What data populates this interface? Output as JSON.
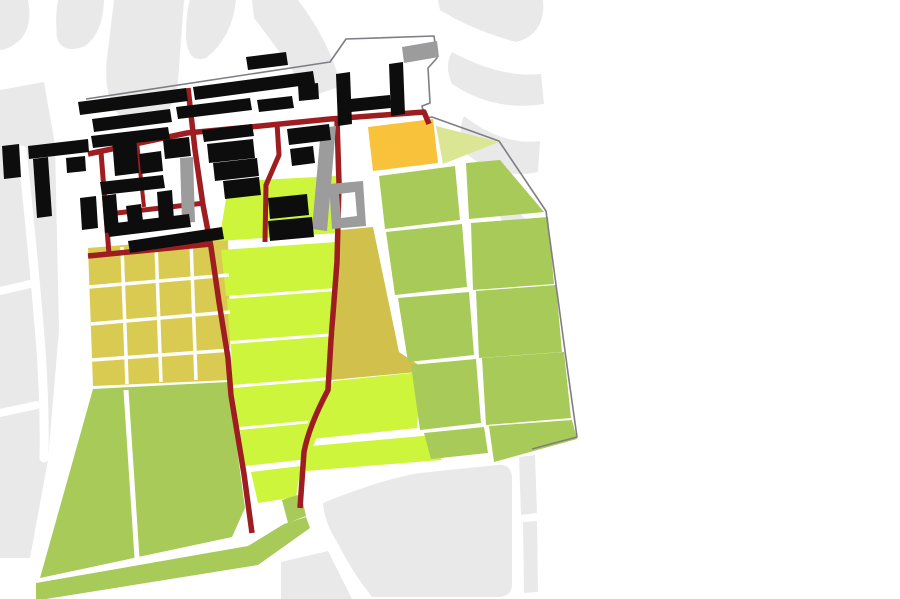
{
  "title": "urban-landuse-site-plan",
  "palette": {
    "background": "#ffffff",
    "city_block": "#e9e9e9",
    "street": "#ffffff",
    "site_boundary": "#7e7e84",
    "road": "#9e1d20",
    "building_primary": "#0d0d0d",
    "building_secondary": "#9c9c9c",
    "parcel_chartreuse": "#ccf53c",
    "parcel_green": "#a7ca58",
    "parcel_khaki": "#d9cb52",
    "parcel_olive": "#d1c14c",
    "parcel_orange": "#f8c23a",
    "parcel_pale_green": "#dbe695"
  },
  "map": {
    "viewbox": "0 0 900 599",
    "layers": [
      {
        "name": "city-blocks",
        "fill": "#e9e9e9",
        "shapes": [
          {
            "name": "block-topleft-1",
            "d": "M 0,0 L 28,0 Q 33,26 20,40 Q 8,50 0,50 Z"
          },
          {
            "name": "block-topleft-2",
            "d": "M 58,0 L 104,0 Q 103,33 85,46 Q 63,55 57,38 Q 55,15 58,0 Z"
          },
          {
            "name": "block-topleft-band",
            "d": "M 114,0 L 184,0 L 177,94 Q 158,138 121,117 Q 101,98 108,50 Z"
          },
          {
            "name": "block-left-strip",
            "d": "M 0,90 L 44,82 L 55,145 L 59,330 L 48,460 L 30,558 L 0,558 Z"
          },
          {
            "name": "block-topcenter-swoosh-left",
            "d": "M 190,0 L 236,0 Q 232,38 206,58 Q 188,64 186,38 Q 186,12 190,0 Z"
          },
          {
            "name": "block-topcenter-swoosh-right",
            "d": "M 252,0 L 298,0 Q 330,42 341,86 L 310,97 Q 283,55 254,18 Z"
          },
          {
            "name": "block-topright-swoosh-1",
            "d": "M 438,0 L 543,0 Q 546,34 516,42 Q 472,30 440,10 Z"
          },
          {
            "name": "block-topright-swoosh-2",
            "d": "M 452,52 Q 500,78 541,74 L 544,104 Q 494,112 452,84 Q 444,66 452,52 Z"
          },
          {
            "name": "block-topright-swoosh-3",
            "d": "M 464,116 Q 503,146 540,141 L 538,172 Q 499,180 468,155 Q 456,134 464,116 Z"
          },
          {
            "name": "block-topright-swoosh-4",
            "d": "M 495,185 Q 515,205 531,227 L 512,237 Q 498,213 487,197 Z"
          },
          {
            "name": "block-bottomright-main",
            "d": "M 323,503 Q 382,479 420,473 L 497,465 Q 511,463 512,477 L 512,584 Q 512,597 498,597 L 372,597 Q 352,572 337,542 Q 324,521 323,503 Z"
          },
          {
            "name": "block-bottomcenter",
            "d": "M 281,562 L 328,551 L 352,599 L 281,599 Z"
          },
          {
            "name": "block-bottomright-strip-1",
            "d": "M 519,457 L 535,455 L 537,513 L 521,515 Z"
          },
          {
            "name": "block-bottomright-strip-2",
            "d": "M 523,522 L 537,521 L 538,592 L 524,593 Z"
          }
        ]
      },
      {
        "name": "city-streets",
        "stroke": "#ffffff",
        "cap": "round",
        "shapes": [
          {
            "name": "street-left-curved",
            "d": "M 22,150 Q 34,260 41,350 Q 45,410 44,458",
            "w": 9
          },
          {
            "name": "street-left-cut-1",
            "d": "M 0,291 L 30,284",
            "w": 8
          },
          {
            "name": "street-left-cut-2",
            "d": "M 0,413 L 37,405",
            "w": 8
          }
        ]
      },
      {
        "name": "parcels",
        "shapes": [
          {
            "name": "parcel-khaki-grid",
            "fill": "#d9cb52",
            "d": "M 88,248 L 228,236 L 231,380 L 93,386 Z"
          },
          {
            "name": "parcel-olive",
            "fill": "#d1c14c",
            "d": "M 340,230 L 373,227 L 399,352 L 428,371 L 331,380 L 336,300 Z"
          },
          {
            "name": "parcel-orange",
            "fill": "#f8c23a",
            "d": "M 368,127 L 433,119 L 438,163 L 373,171 Z"
          },
          {
            "name": "parcel-pale-triangle",
            "fill": "#dbe695",
            "d": "M 436,126 L 499,142 L 443,164 Z"
          },
          {
            "name": "parcel-chartreuse-1",
            "fill": "#ccf53c",
            "d": "M 228,187 Q 232,182 240,181 L 336,176 L 337,233 L 219,241 Z"
          },
          {
            "name": "parcel-chartreuse-2",
            "fill": "#ccf53c",
            "d": "M 221,250 L 336,242 L 336,288 L 226,296 Z"
          },
          {
            "name": "parcel-chartreuse-3",
            "fill": "#ccf53c",
            "d": "M 227,299 L 336,291 L 335,333 L 230,341 Z"
          },
          {
            "name": "parcel-chartreuse-4",
            "fill": "#ccf53c",
            "d": "M 231,344 L 334,336 L 331,377 L 232,385 Z"
          },
          {
            "name": "parcel-chartreuse-5",
            "fill": "#ccf53c",
            "d": "M 233,388 L 330,380 L 325,419 L 239,427 Z"
          },
          {
            "name": "parcel-chartreuse-6",
            "fill": "#ccf53c",
            "d": "M 240,430 L 323,422 L 308,459 L 245,466 Z"
          },
          {
            "name": "parcel-chartreuse-7",
            "fill": "#ccf53c",
            "d": "M 251,472 L 301,466 L 296,497 L 258,503 Z"
          },
          {
            "name": "parcel-chartreuse-8",
            "fill": "#ccf53c",
            "d": "M 333,381 L 421,372 L 417,428 L 302,440 L 311,414 L 326,394 Z"
          },
          {
            "name": "parcel-chartreuse-9",
            "fill": "#ccf53c",
            "d": "M 300,447 L 444,434 L 441,460 L 306,471 Z"
          },
          {
            "name": "parcel-green-r1-left",
            "fill": "#a7ca58",
            "d": "M 379,176 L 455,166 L 460,220 L 385,229 Z"
          },
          {
            "name": "parcel-green-r1-right",
            "fill": "#a7ca58",
            "d": "M 466,163 L 500,160 L 544,212 L 469,219 Z"
          },
          {
            "name": "parcel-green-r2-left",
            "fill": "#a7ca58",
            "d": "M 386,232 L 462,224 L 467,287 L 395,295 Z"
          },
          {
            "name": "parcel-green-r2-right",
            "fill": "#a7ca58",
            "d": "M 471,223 L 548,217 L 554,284 L 473,290 Z"
          },
          {
            "name": "parcel-green-r3-left",
            "fill": "#a7ca58",
            "d": "M 398,298 L 469,292 L 474,355 L 408,362 Z"
          },
          {
            "name": "parcel-green-r3-right",
            "fill": "#a7ca58",
            "d": "M 476,291 L 556,285 L 562,352 L 479,358 Z"
          },
          {
            "name": "parcel-green-r4-left",
            "fill": "#a7ca58",
            "d": "M 411,365 L 476,359 L 481,423 L 420,430 Z"
          },
          {
            "name": "parcel-green-r4-right",
            "fill": "#a7ca58",
            "d": "M 482,358 L 564,352 L 571,418 L 486,425 Z"
          },
          {
            "name": "parcel-green-r5-left",
            "fill": "#a7ca58",
            "d": "M 424,433 L 484,427 L 488,453 L 431,459 Z"
          },
          {
            "name": "parcel-green-r5-right",
            "fill": "#a7ca58",
            "d": "M 489,426 L 572,420 L 577,439 L 494,462 Z"
          },
          {
            "name": "parcel-green-southwest",
            "fill": "#a7ca58",
            "d": "M 93,389 L 228,382 L 245,508 L 232,537 L 40,578 Z"
          },
          {
            "name": "parcel-green-band-tip",
            "fill": "#a7ca58",
            "d": "M 282,500 L 301,494 L 306,516 L 288,523 Z"
          },
          {
            "name": "parcel-green-band",
            "fill": "#a7ca58",
            "d": "M 36,583 L 248,546 L 284,524 L 306,517 L 310,528 L 258,565 L 46,599 L 36,599 Z"
          }
        ]
      },
      {
        "name": "parcel-streets",
        "stroke": "#ffffff",
        "shapes": [
          {
            "name": "khaki-street-v1",
            "d": "M 122,247 L 127,384",
            "w": 3.5
          },
          {
            "name": "khaki-street-v2",
            "d": "M 156,244 L 161,382",
            "w": 3.5
          },
          {
            "name": "khaki-street-v3",
            "d": "M 191,241 L 196,380",
            "w": 3.5
          },
          {
            "name": "khaki-street-h1",
            "d": "M 89,287 L 229,275",
            "w": 3.5
          },
          {
            "name": "khaki-street-h2",
            "d": "M 91,324 L 230,312",
            "w": 3.5
          },
          {
            "name": "khaki-street-h3",
            "d": "M 92,360 L 231,350",
            "w": 3.5
          },
          {
            "name": "green-southwest-divider",
            "d": "M 126,390 L 137,558",
            "w": 5
          }
        ]
      },
      {
        "name": "site-boundary",
        "stroke": "#7e7e84",
        "shapes": [
          {
            "name": "boundary-line",
            "d": "M 86,99 L 330,62 L 346,39 L 434,36 L 437,58 L 428,68 L 430,103 L 422,106 L 425,118 L 432,117 L 499,141 L 546,211 L 568,373 L 577,437 L 532,449",
            "w": 1.6
          }
        ]
      },
      {
        "name": "roads",
        "stroke": "#9e1d20",
        "shapes": [
          {
            "name": "road-top-horizontal",
            "d": "M 88,154 L 187,133 L 250,127 L 330,119 L 424,112 L 429,124",
            "w": 5.5
          },
          {
            "name": "road-mid-horizontal",
            "d": "M 108,214 L 205,203",
            "w": 5
          },
          {
            "name": "road-lower-horizontal",
            "d": "M 88,256 L 211,244",
            "w": 5.5
          },
          {
            "name": "road-west-vertical",
            "d": "M 101,152 L 109,254",
            "w": 5
          },
          {
            "name": "road-short-vertical",
            "d": "M 137,142 L 144,207",
            "w": 4
          },
          {
            "name": "road-long-west-vertical",
            "d": "M 188,88 L 195,150 L 203,205 L 211,247 L 219,302 L 228,358 L 231,395 L 244,474 L 252,533",
            "w": 5.5
          },
          {
            "name": "road-center-vertical",
            "d": "M 277,123 L 279,155 L 266,185 L 265,242",
            "w": 5
          },
          {
            "name": "road-long-east-vertical",
            "d": "M 337,120 L 339,183 L 337,262 L 331,340 L 328,390 Q 309,426 304,452 L 300,508",
            "w": 5.5
          }
        ]
      },
      {
        "name": "buildings-secondary",
        "fill": "#9c9c9c",
        "shapes": [
          {
            "name": "gray-slab",
            "d": "M 321,128 L 336,126 L 327,231 L 312,229 Z"
          },
          {
            "name": "gray-bar",
            "d": "M 180,158 L 193,157 L 195,222 L 182,223 Z"
          },
          {
            "name": "gray-topright-bar",
            "d": "M 402,47 L 437,41 L 439,57 L 404,63 Z"
          },
          {
            "name": "gray-ring-building",
            "rule": "evenodd",
            "d": "M 329,184 L 363,181 L 366,226 L 332,229 Z M 339,194 L 355,192 L 357,216 L 341,218 Z"
          }
        ]
      },
      {
        "name": "buildings-primary",
        "fill": "#0d0d0d",
        "shapes": [
          {
            "name": "bldg-row1-a",
            "d": "M 78,102 L 186,88 L 188,101 L 80,115 Z"
          },
          {
            "name": "bldg-row1-b",
            "d": "M 193,87 L 313,71 L 315,84 L 195,100 Z"
          },
          {
            "name": "bldg-row2-a",
            "d": "M 92,119 L 170,109 L 172,122 L 94,132 Z"
          },
          {
            "name": "bldg-row2-b",
            "d": "M 176,107 L 250,98 L 252,110 L 178,119 Z"
          },
          {
            "name": "bldg-row2-c",
            "d": "M 257,100 L 292,96 L 294,108 L 259,112 Z"
          },
          {
            "name": "bldg-top-small",
            "d": "M 246,57 L 286,52 L 288,65 L 248,70 Z"
          },
          {
            "name": "bldg-h-left",
            "d": "M 336,74 L 350,72 L 352,124 L 338,126 Z"
          },
          {
            "name": "bldg-h-right",
            "d": "M 389,64 L 403,62 L 405,114 L 391,116 Z"
          },
          {
            "name": "bldg-h-cross",
            "d": "M 350,99 L 390,95 L 391,108 L 351,112 Z"
          },
          {
            "name": "bldg-h-small",
            "d": "M 298,85 L 318,83 L 319,99 L 299,101 Z"
          },
          {
            "name": "bldg-row3-a",
            "d": "M 91,136 L 168,127 L 170,139 L 93,148 Z"
          },
          {
            "name": "bldg-row3-b",
            "d": "M 202,130 L 252,124 L 254,136 L 204,142 Z"
          },
          {
            "name": "bldg-row3-c",
            "d": "M 287,129 L 329,124 L 331,140 L 289,145 Z"
          },
          {
            "name": "bldg-mid-a",
            "d": "M 112,139 L 136,136 L 139,173 L 115,176 Z"
          },
          {
            "name": "bldg-mid-b",
            "d": "M 139,154 L 161,151 L 163,171 L 141,174 Z"
          },
          {
            "name": "bldg-mid-c",
            "d": "M 163,140 L 189,137 L 191,156 L 165,159 Z"
          },
          {
            "name": "bldg-mid-d",
            "d": "M 207,144 L 253,139 L 255,158 L 209,163 Z"
          },
          {
            "name": "bldg-mid-e",
            "d": "M 290,149 L 313,146 L 315,163 L 292,166 Z"
          },
          {
            "name": "bldg-mid-f",
            "d": "M 213,163 L 257,158 L 259,176 L 215,181 Z"
          },
          {
            "name": "bldg-east-a",
            "d": "M 268,198 L 307,194 L 309,215 L 270,219 Z"
          },
          {
            "name": "bldg-east-b",
            "d": "M 268,221 L 312,217 L 314,237 L 270,241 Z"
          },
          {
            "name": "bldg-east-c",
            "d": "M 223,181 L 259,177 L 261,195 L 225,199 Z"
          },
          {
            "name": "bldg-long-bottom",
            "d": "M 128,241 L 222,227 L 224,239 L 130,253 Z"
          },
          {
            "name": "bldg-west-l",
            "d": "M 2,146 L 19,144 L 21,177 L 4,179 Z"
          },
          {
            "name": "bldg-west-bar",
            "d": "M 28,146 L 88,139 L 89,152 L 29,159 Z"
          },
          {
            "name": "bldg-west-leg",
            "d": "M 33,159 L 48,157 L 52,216 L 37,218 Z"
          },
          {
            "name": "bldg-west-block-1",
            "d": "M 66,158 L 85,156 L 86,171 L 67,173 Z"
          },
          {
            "name": "bldg-west-block-2",
            "d": "M 80,198 L 96,196 L 98,228 L 82,230 Z"
          },
          {
            "name": "bldg-court-top",
            "d": "M 100,182 L 163,175 L 165,188 L 102,195 Z"
          },
          {
            "name": "bldg-court-left",
            "d": "M 102,196 L 116,194 L 119,231 L 105,233 Z"
          },
          {
            "name": "bldg-court-bottom",
            "d": "M 107,224 L 189,214 L 191,227 L 109,237 Z"
          },
          {
            "name": "bldg-court-right",
            "d": "M 157,192 L 172,190 L 174,220 L 159,222 Z"
          },
          {
            "name": "bldg-court-inner",
            "d": "M 126,206 L 141,204 L 143,221 L 128,223 Z"
          }
        ]
      }
    ]
  }
}
